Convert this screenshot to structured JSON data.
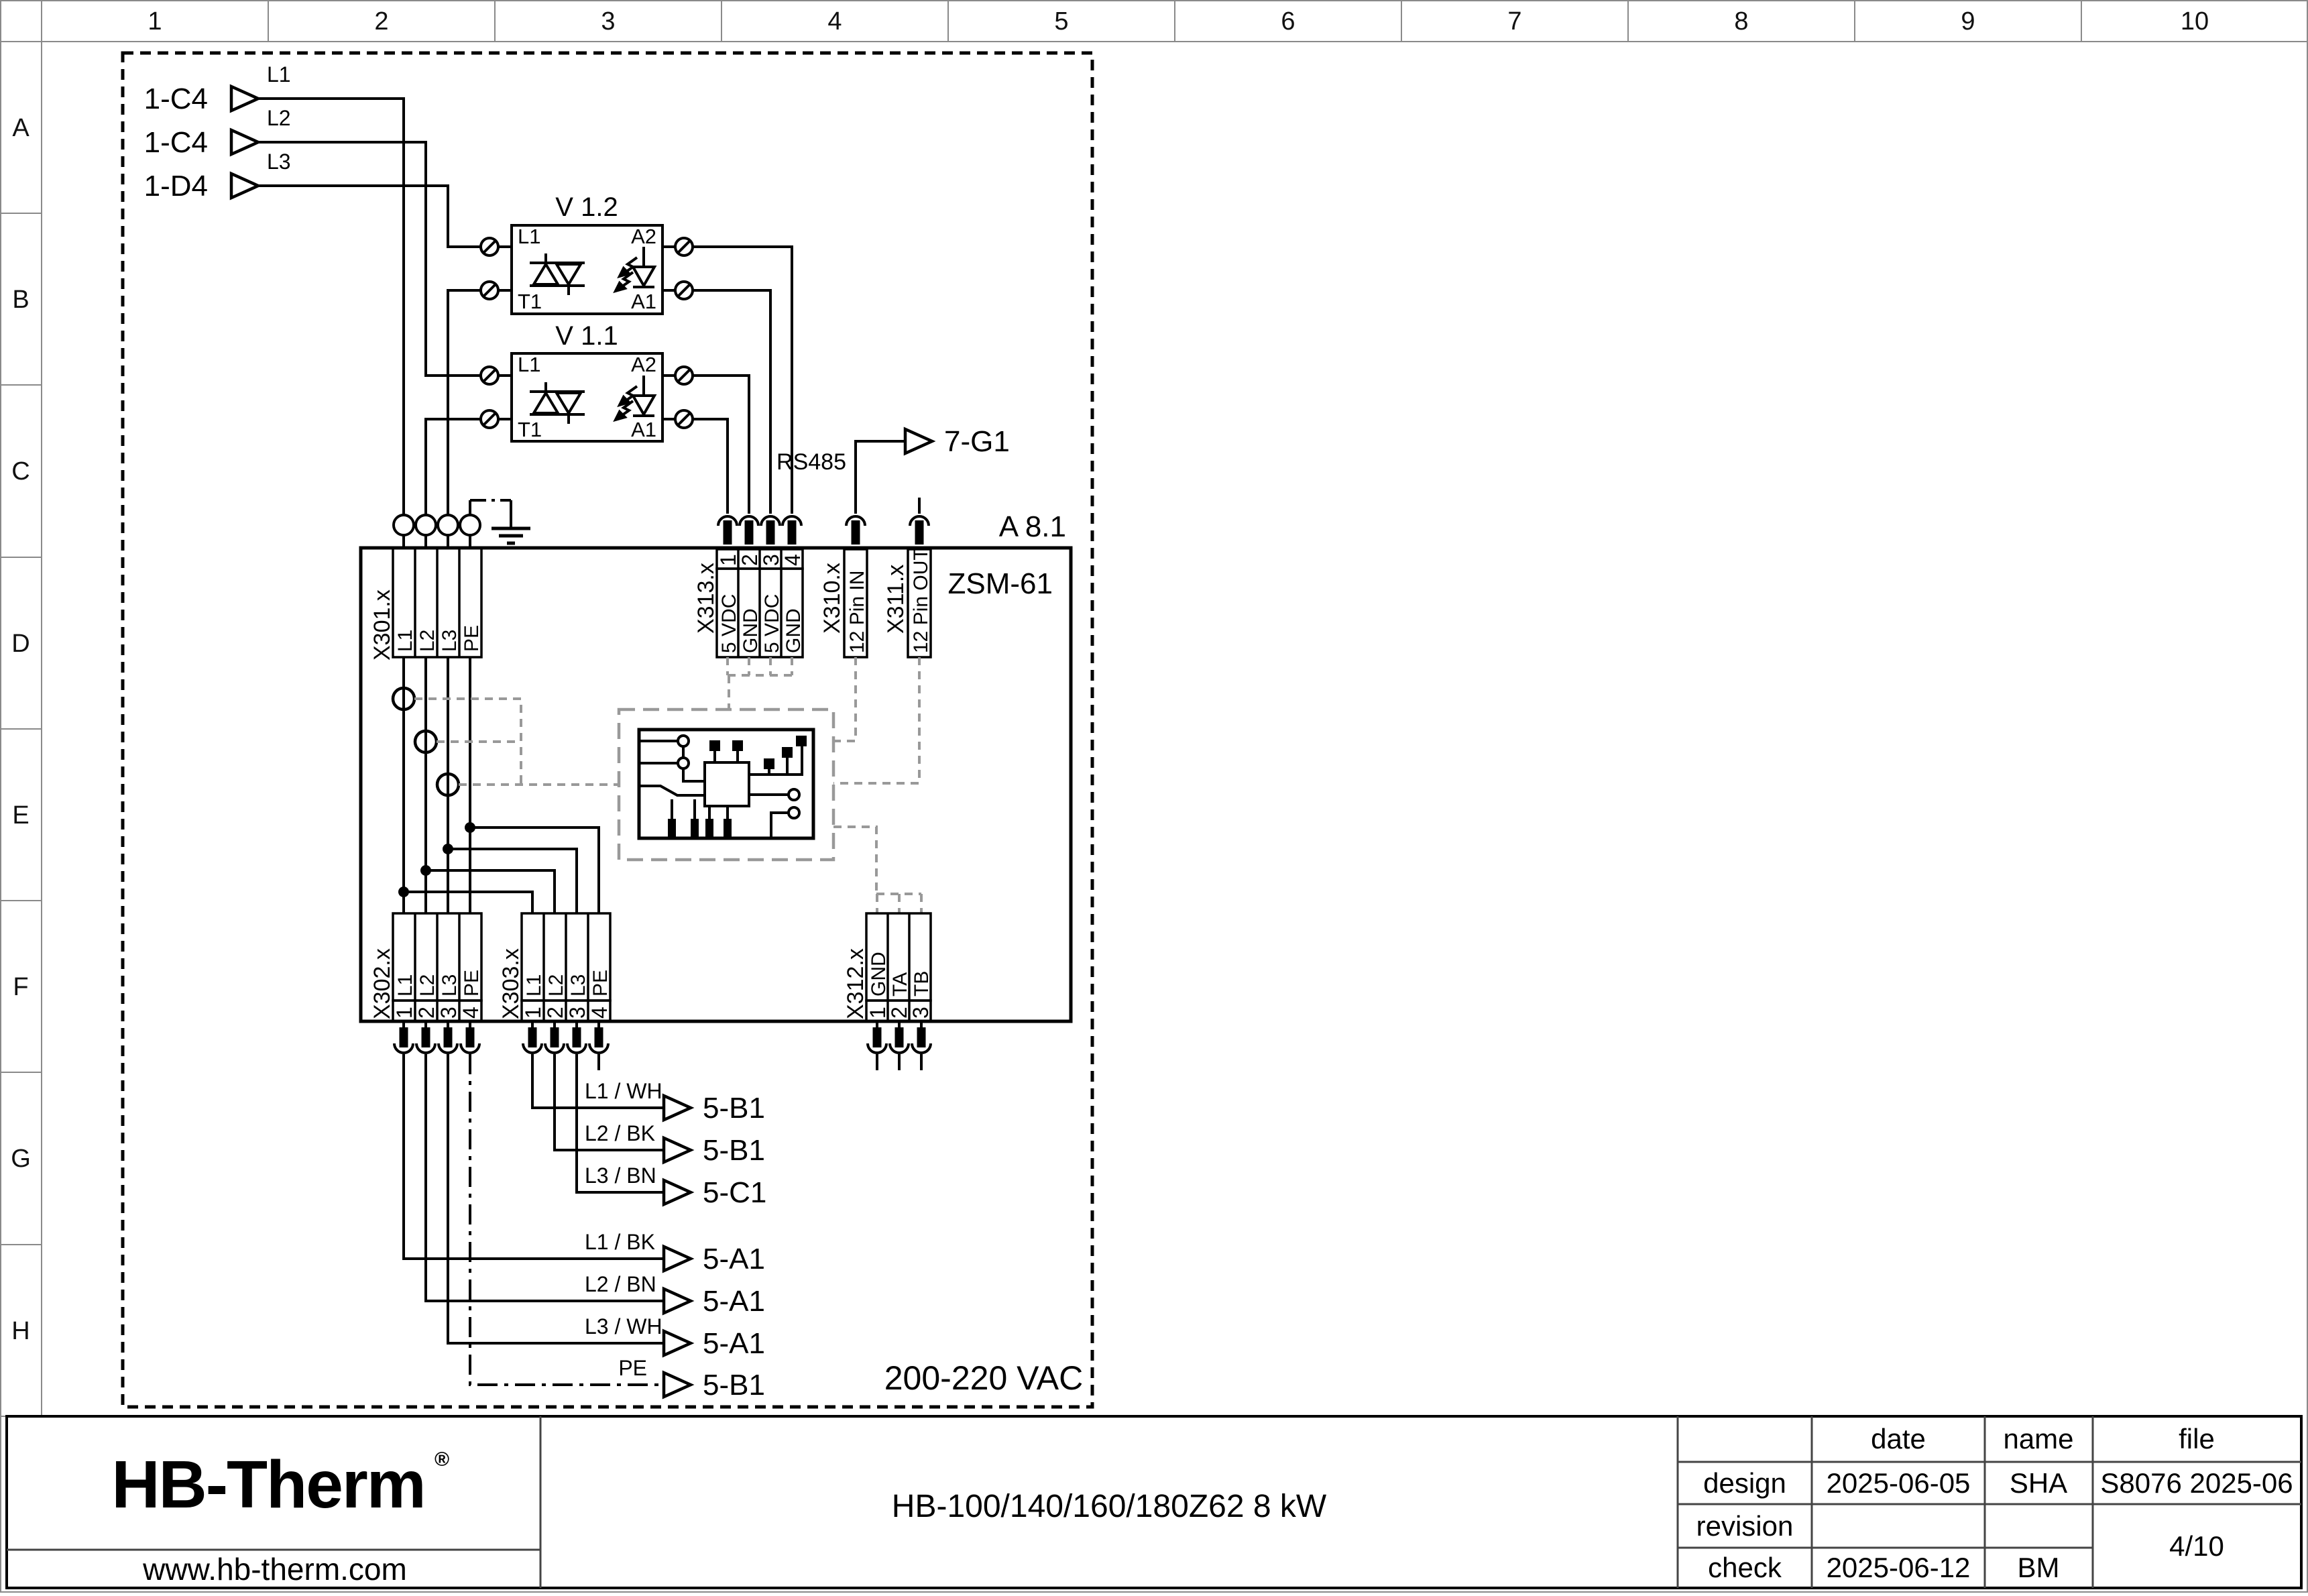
{
  "grid": {
    "columns": [
      "1",
      "2",
      "3",
      "4",
      "5",
      "6",
      "7",
      "8",
      "9",
      "10"
    ],
    "rows": [
      "A",
      "B",
      "C",
      "D",
      "E",
      "F",
      "G",
      "H"
    ]
  },
  "inputs": [
    {
      "ref": "1-C4",
      "phase": "L1"
    },
    {
      "ref": "1-C4",
      "phase": "L2"
    },
    {
      "ref": "1-D4",
      "phase": "L3"
    }
  ],
  "ssr": [
    {
      "id": "V 1.2",
      "pins": {
        "in_top": "L1",
        "in_bottom": "T1",
        "out_top": "A2",
        "out_bottom": "A1"
      }
    },
    {
      "id": "V 1.1",
      "pins": {
        "in_top": "L1",
        "in_bottom": "T1",
        "out_top": "A2",
        "out_bottom": "A1"
      }
    }
  ],
  "module": {
    "ref": "A 8.1",
    "name": "ZSM-61",
    "supply": "200-220 VAC"
  },
  "comm": {
    "bus": "RS485",
    "target": "7-G1"
  },
  "connectors": {
    "x301": {
      "label": "X301.x",
      "pins": [
        "L1",
        "L2",
        "L3",
        "PE"
      ]
    },
    "x313": {
      "label": "X313.x",
      "pins": [
        {
          "n": "1",
          "signal": "5 VDC"
        },
        {
          "n": "2",
          "signal": "GND"
        },
        {
          "n": "3",
          "signal": "5 VDC"
        },
        {
          "n": "4",
          "signal": "GND"
        }
      ]
    },
    "x310": {
      "label": "X310.x",
      "signal": "12 Pin IN"
    },
    "x311": {
      "label": "X311.x",
      "signal": "12 Pin OUT"
    },
    "x302": {
      "label": "X302.x",
      "pins": [
        {
          "n": "1",
          "signal": "L1"
        },
        {
          "n": "2",
          "signal": "L2"
        },
        {
          "n": "3",
          "signal": "L3"
        },
        {
          "n": "4",
          "signal": "PE"
        }
      ]
    },
    "x303": {
      "label": "X303.x",
      "pins": [
        {
          "n": "1",
          "signal": "L1"
        },
        {
          "n": "2",
          "signal": "L2"
        },
        {
          "n": "3",
          "signal": "L3"
        },
        {
          "n": "4",
          "signal": "PE"
        }
      ]
    },
    "x312": {
      "label": "X312.x",
      "pins": [
        {
          "n": "1",
          "signal": "GND"
        },
        {
          "n": "2",
          "signal": "TA"
        },
        {
          "n": "3",
          "signal": "TB"
        }
      ]
    }
  },
  "outputs_upper": [
    {
      "wire": "L1 / WH",
      "target": "5-B1"
    },
    {
      "wire": "L2 / BK",
      "target": "5-B1"
    },
    {
      "wire": "L3 / BN",
      "target": "5-C1"
    }
  ],
  "outputs_lower": [
    {
      "wire": "L1 / BK",
      "target": "5-A1"
    },
    {
      "wire": "L2 / BN",
      "target": "5-A1"
    },
    {
      "wire": "L3 / WH",
      "target": "5-A1"
    },
    {
      "wire": "PE",
      "target": "5-B1"
    }
  ],
  "titleblock": {
    "logo": "HB-Therm",
    "logo_reg": "®",
    "website": "www.hb-therm.com",
    "title": "HB-100/140/160/180Z62 8 kW",
    "table": {
      "date_header": "date",
      "name_header": "name",
      "file_header": "file",
      "design_label": "design",
      "design_date": "2025-06-05",
      "design_name": "SHA",
      "file_value": "S8076 2025-06",
      "revision_label": "revision",
      "check_label": "check",
      "check_date": "2025-06-12",
      "check_name": "BM",
      "page": "4/10"
    }
  },
  "colors": {
    "wire": "#000000",
    "dashed_aux": "#999999",
    "logo_navy": "#14213d",
    "grid_line": "#8a8a8a"
  }
}
